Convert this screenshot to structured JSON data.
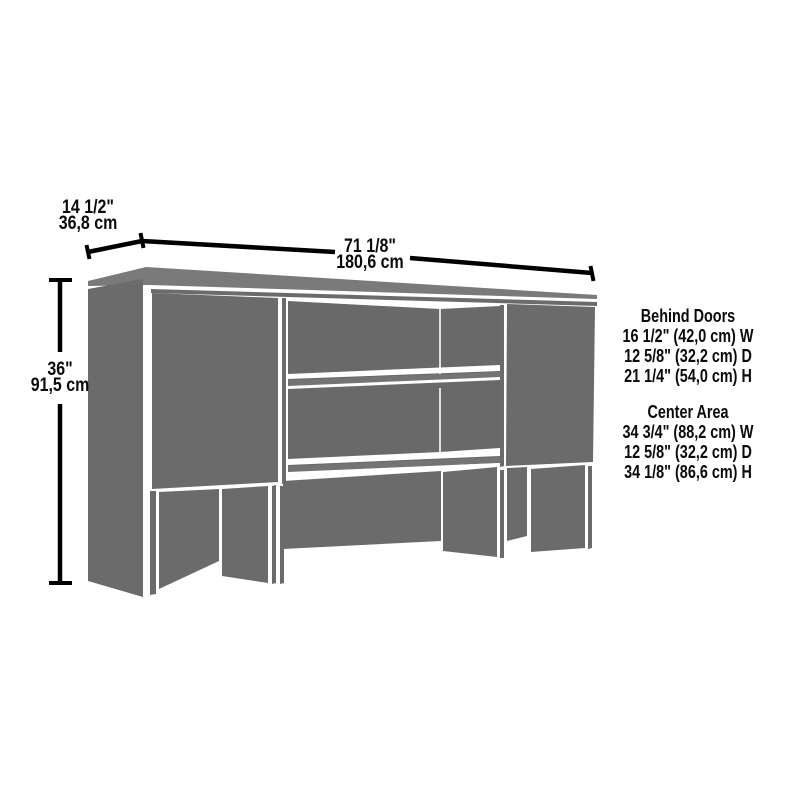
{
  "diagram": {
    "kind": "furniture-dimension-diagram",
    "item": "hutch with two doors and open center shelves",
    "colors": {
      "panel_gray": "#6b6b6b",
      "top_face_gray": "#7a7a7a",
      "interior_gray": "#696969",
      "shelf_front_gray": "#747474",
      "dimension_line": "#000000",
      "text": "#0a0a0a",
      "background": "#ffffff"
    }
  },
  "dimensions": {
    "depth": {
      "inches": "14 1/2\"",
      "cm": "36,8 cm"
    },
    "width": {
      "inches": "71 1/8\"",
      "cm": "180,6 cm"
    },
    "height": {
      "inches": "36\"",
      "cm": "91,5 cm"
    }
  },
  "specs": {
    "behind_doors": {
      "heading": "Behind Doors",
      "lines": [
        "16 1/2\" (42,0 cm) W",
        "12 5/8\" (32,2 cm) D",
        "21 1/4\" (54,0 cm) H"
      ]
    },
    "center_area": {
      "heading": "Center Area",
      "lines": [
        "34 3/4\" (88,2 cm) W",
        "12 5/8\" (32,2 cm) D",
        "34 1/8\" (86,6 cm) H"
      ]
    }
  }
}
